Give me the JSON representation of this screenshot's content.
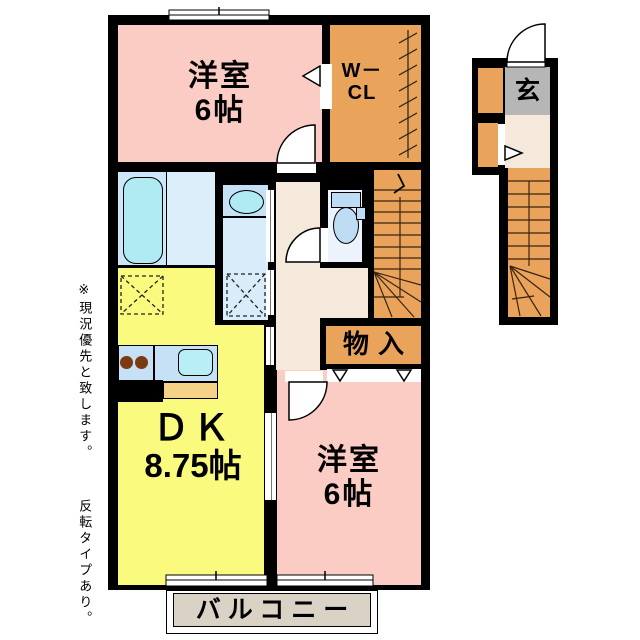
{
  "plan": {
    "rooms": {
      "western_top": {
        "name": "洋室",
        "size": "6帖"
      },
      "wcl": {
        "line1": "W－",
        "line2": "CL"
      },
      "storage": {
        "label": "物入"
      },
      "dk": {
        "name": "ＤＫ",
        "size": "8.75帖"
      },
      "western_bottom": {
        "name": "洋室",
        "size": "6帖"
      },
      "balcony": {
        "label": "バルコニー"
      },
      "entrance": {
        "label": "玄"
      }
    },
    "notes": {
      "priority": "※現況優先と致します。",
      "reverse": "反転タイプあり。"
    }
  },
  "colors": {
    "wall": "#000000",
    "room_pink": "#fbccc3",
    "orange": "#e9a35b",
    "dk_yellow": "#fafa7f",
    "bath_blue": "#cde7f8",
    "bath_floor": "#dceefa",
    "tub_cyan": "#b0eaf3",
    "washroom_blue": "#d9ecfa",
    "counter_blue": "#c6e1f5",
    "sink_cyan": "#b8eef6",
    "burner_brown": "#7a3a12",
    "hall_beige": "#f5e9db",
    "toilet_floor": "#ecf3fc",
    "fixture_blue": "#bedcf4",
    "genkan_gray": "#b6b6b6",
    "balcony_gray": "#d9d2c5",
    "counter_tan": "#f5d287"
  }
}
